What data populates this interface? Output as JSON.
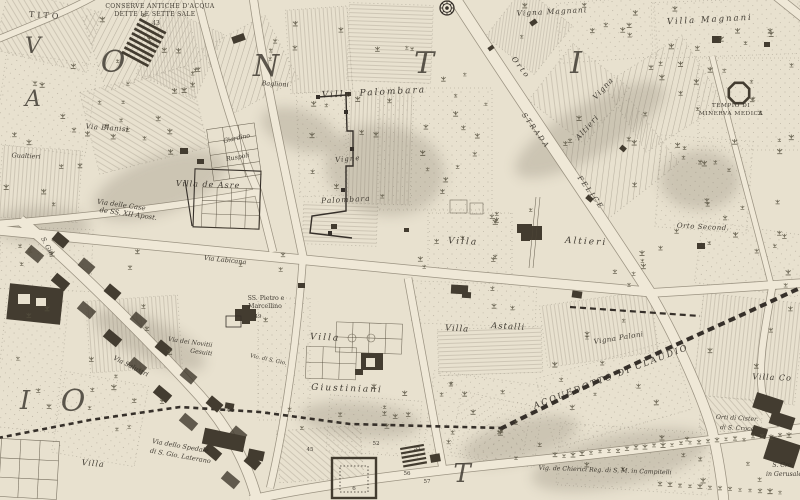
{
  "map": {
    "palette": {
      "parchment": "#e8e1cf",
      "road_fill": "#efe8d7",
      "road_edge": "#8d8574",
      "ink": "#36302a",
      "hatch": "#8a8173",
      "building": "#433c30",
      "shade": "#8c8474",
      "label_ink": "#332e26"
    },
    "district_letters": [
      {
        "t": "O",
        "x": 113,
        "y": 72,
        "s": 30
      },
      {
        "t": "N",
        "x": 266,
        "y": 76,
        "s": 30
      },
      {
        "t": "T",
        "x": 424,
        "y": 73,
        "s": 30
      },
      {
        "t": "I",
        "x": 576,
        "y": 73,
        "s": 30
      },
      {
        "t": "O",
        "x": 73,
        "y": 411,
        "s": 30
      },
      {
        "t": "I",
        "x": 25,
        "y": 409,
        "s": 26
      },
      {
        "t": "T",
        "x": 462,
        "y": 482,
        "s": 26
      },
      {
        "t": "V",
        "x": 33,
        "y": 53,
        "s": 22
      },
      {
        "t": "A",
        "x": 33,
        "y": 106,
        "s": 22
      }
    ],
    "labels": [
      {
        "t": "TITO",
        "x": 45,
        "y": 18,
        "r": 4,
        "s": 8,
        "sp": 3,
        "it": 0
      },
      {
        "t": "CONSERVE ANTICHE D'ACQUA",
        "x": 160,
        "y": 8,
        "r": 0,
        "s": 6,
        "sp": 0.4,
        "it": 0
      },
      {
        "t": "DETTE LE SETTE SALE",
        "x": 155,
        "y": 16,
        "r": 0,
        "s": 6,
        "sp": 0.4,
        "it": 0
      },
      {
        "t": "43",
        "x": 156,
        "y": 25,
        "r": 0,
        "s": 6,
        "sp": 0,
        "it": 0
      },
      {
        "t": "Vigna Magnani",
        "x": 552,
        "y": 14,
        "r": -3,
        "s": 7.5,
        "sp": 1,
        "it": 1
      },
      {
        "t": "Villa  Magnani",
        "x": 710,
        "y": 22,
        "r": -3,
        "s": 8.5,
        "sp": 2,
        "it": 1
      },
      {
        "t": "TEMPIO DI",
        "x": 731,
        "y": 107,
        "r": 0,
        "s": 5.8,
        "sp": 0.5,
        "it": 0
      },
      {
        "t": "MINERVA MEDICA",
        "x": 731,
        "y": 115,
        "r": 0,
        "s": 5.8,
        "sp": 0.5,
        "it": 0
      },
      {
        "t": "Orto",
        "x": 519,
        "y": 69,
        "r": 52,
        "s": 7.5,
        "sp": 2,
        "it": 1
      },
      {
        "t": "Vigna",
        "x": 605,
        "y": 90,
        "r": -48,
        "s": 7.5,
        "sp": 1,
        "it": 1
      },
      {
        "t": "Altieri",
        "x": 589,
        "y": 129,
        "r": -48,
        "s": 7.5,
        "sp": 1,
        "it": 1
      },
      {
        "t": "STRADA",
        "x": 534,
        "y": 132,
        "r": 54,
        "s": 7,
        "sp": 2,
        "it": 1
      },
      {
        "t": "FELICE",
        "x": 589,
        "y": 194,
        "r": 54,
        "s": 7,
        "sp": 2,
        "it": 1
      },
      {
        "t": "Villa",
        "x": 337,
        "y": 97,
        "r": -2,
        "s": 9,
        "sp": 2,
        "it": 1
      },
      {
        "t": "Palombara",
        "x": 393,
        "y": 94,
        "r": -3,
        "s": 9,
        "sp": 2,
        "it": 1
      },
      {
        "t": "Vigne",
        "x": 348,
        "y": 161,
        "r": -5,
        "s": 7,
        "sp": 1,
        "it": 1
      },
      {
        "t": "Palombara",
        "x": 346,
        "y": 202,
        "r": -3,
        "s": 7.5,
        "sp": 1,
        "it": 1
      },
      {
        "t": "Baglioni",
        "x": 275,
        "y": 86,
        "r": 3,
        "s": 6.5,
        "sp": 0,
        "it": 1
      },
      {
        "t": "Via Blanisi",
        "x": 107,
        "y": 130,
        "r": 4,
        "s": 7,
        "sp": 0.5,
        "it": 1
      },
      {
        "t": "Gualtieri",
        "x": 26,
        "y": 158,
        "r": 3,
        "s": 6.5,
        "sp": 0,
        "it": 1
      },
      {
        "t": "Giardino",
        "x": 237,
        "y": 140,
        "r": -12,
        "s": 6.2,
        "sp": 0,
        "it": 1
      },
      {
        "t": "Ruspoli",
        "x": 238,
        "y": 159,
        "r": -10,
        "s": 6.2,
        "sp": 0,
        "it": 1
      },
      {
        "t": "Villa de Asre",
        "x": 208,
        "y": 187,
        "r": 2,
        "s": 8,
        "sp": 1,
        "it": 1
      },
      {
        "t": "Via delle Case",
        "x": 121,
        "y": 207,
        "r": 8,
        "s": 6.8,
        "sp": 0,
        "it": 1
      },
      {
        "t": "de SS. XII Apost.",
        "x": 128,
        "y": 216,
        "r": 8,
        "s": 6.8,
        "sp": 0,
        "it": 1
      },
      {
        "t": "Villa",
        "x": 463,
        "y": 244,
        "r": 3,
        "s": 9,
        "sp": 2,
        "it": 1
      },
      {
        "t": "Altieri",
        "x": 586,
        "y": 244,
        "r": 3,
        "s": 9,
        "sp": 2,
        "it": 1
      },
      {
        "t": "Orto Second.",
        "x": 703,
        "y": 229,
        "r": 3,
        "s": 7,
        "sp": 0.5,
        "it": 1
      },
      {
        "t": "SS. Pietro e",
        "x": 266,
        "y": 300,
        "r": 0,
        "s": 6.2,
        "sp": 0,
        "it": 0
      },
      {
        "t": "Marcellino",
        "x": 265,
        "y": 308,
        "r": 0,
        "s": 6.2,
        "sp": 0,
        "it": 0
      },
      {
        "t": "49",
        "x": 258,
        "y": 318,
        "r": 0,
        "s": 5.5,
        "sp": 0,
        "it": 0
      },
      {
        "t": "Via Labicana",
        "x": 225,
        "y": 262,
        "r": 6,
        "s": 6.5,
        "sp": 0,
        "it": 1
      },
      {
        "t": "S. Gio.",
        "x": 46,
        "y": 248,
        "r": 62,
        "s": 6.5,
        "sp": 0,
        "it": 1
      },
      {
        "t": "Villa",
        "x": 325,
        "y": 340,
        "r": 3,
        "s": 9,
        "sp": 2,
        "it": 1
      },
      {
        "t": "Giustiniani",
        "x": 347,
        "y": 391,
        "r": 2,
        "s": 9,
        "sp": 2,
        "it": 1
      },
      {
        "t": "Villa",
        "x": 457,
        "y": 331,
        "r": 3,
        "s": 8.5,
        "sp": 1,
        "it": 1
      },
      {
        "t": "Astalli",
        "x": 508,
        "y": 329,
        "r": 3,
        "s": 8.5,
        "sp": 1,
        "it": 1
      },
      {
        "t": "Vigna Paloni",
        "x": 619,
        "y": 340,
        "r": -9,
        "s": 7,
        "sp": 0.5,
        "it": 1
      },
      {
        "t": "Via dei Novitii",
        "x": 190,
        "y": 344,
        "r": 8,
        "s": 6.2,
        "sp": 0,
        "it": 1
      },
      {
        "t": "Gesuiti",
        "x": 201,
        "y": 354,
        "r": 8,
        "s": 6.2,
        "sp": 0,
        "it": 1
      },
      {
        "t": "Vic. di S. Gio.",
        "x": 268,
        "y": 361,
        "r": 12,
        "s": 5.5,
        "sp": 0,
        "it": 1
      },
      {
        "t": "Via Salustri",
        "x": 130,
        "y": 368,
        "r": 27,
        "s": 6.5,
        "sp": 0,
        "it": 1
      },
      {
        "t": "Via dello Spedale",
        "x": 180,
        "y": 448,
        "r": 10,
        "s": 6.5,
        "sp": 0,
        "it": 1
      },
      {
        "t": "di S. Gio. Laterano",
        "x": 180,
        "y": 458,
        "r": 10,
        "s": 6.5,
        "sp": 0,
        "it": 1
      },
      {
        "t": "Villa",
        "x": 93,
        "y": 466,
        "r": 5,
        "s": 8,
        "sp": 1,
        "it": 1
      },
      {
        "t": "ACQUEDOTTO DI CLAUDIO",
        "x": 612,
        "y": 379,
        "r": -21,
        "s": 8.5,
        "sp": 2,
        "it": 1
      },
      {
        "t": "Vig. de Chierici Reg. di S. M. in Campitelli",
        "x": 605,
        "y": 472,
        "r": 2,
        "s": 6.2,
        "sp": 0,
        "it": 1
      },
      {
        "t": "Orti di Cister.",
        "x": 737,
        "y": 420,
        "r": 3,
        "s": 6.2,
        "sp": 0,
        "it": 1
      },
      {
        "t": "di S. Croce",
        "x": 737,
        "y": 430,
        "r": 3,
        "s": 6.2,
        "sp": 0,
        "it": 1
      },
      {
        "t": "S. Cro",
        "x": 782,
        "y": 467,
        "r": 0,
        "s": 6.2,
        "sp": 0,
        "it": 1
      },
      {
        "t": "in Gerusale",
        "x": 784,
        "y": 476,
        "r": 0,
        "s": 6.2,
        "sp": 0,
        "it": 1
      },
      {
        "t": "Villa  Co",
        "x": 772,
        "y": 380,
        "r": 2,
        "s": 8,
        "sp": 1,
        "it": 1
      },
      {
        "t": "44",
        "x": 230,
        "y": 412,
        "r": 0,
        "s": 5.5,
        "sp": 0,
        "it": 0
      },
      {
        "t": "45",
        "x": 310,
        "y": 451,
        "r": 0,
        "s": 5.5,
        "sp": 0,
        "it": 0
      },
      {
        "t": "52",
        "x": 376,
        "y": 445,
        "r": 0,
        "s": 5.5,
        "sp": 0,
        "it": 0
      },
      {
        "t": "55",
        "x": 417,
        "y": 450,
        "r": 0,
        "s": 5.5,
        "sp": 0,
        "it": 0
      },
      {
        "t": "56",
        "x": 407,
        "y": 475,
        "r": 0,
        "s": 5.5,
        "sp": 0,
        "it": 0
      },
      {
        "t": "57",
        "x": 427,
        "y": 483,
        "r": 0,
        "s": 5.5,
        "sp": 0,
        "it": 0
      },
      {
        "t": "6",
        "x": 354,
        "y": 490,
        "r": 0,
        "s": 5.5,
        "sp": 0,
        "it": 0
      }
    ]
  }
}
